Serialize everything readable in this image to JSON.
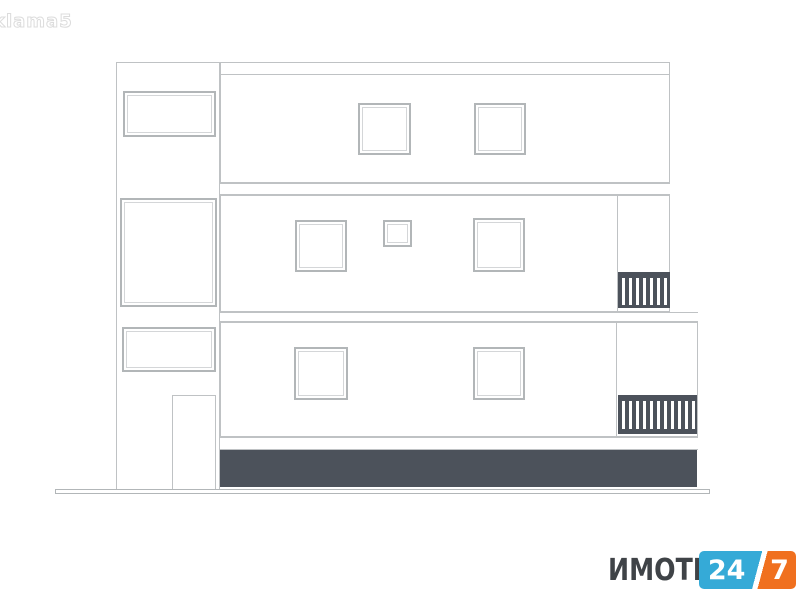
{
  "watermark": {
    "text": "klama5"
  },
  "logo": {
    "brand": "ИМОТИ",
    "badge_left": "24",
    "badge_right": "7"
  },
  "drawing": {
    "kind": "building-side-elevation",
    "floors": 3
  },
  "theme": {
    "line_color": "#bfc2c4",
    "frame_color": "#b2b6b8",
    "inner_frame_color": "#d4d6d8",
    "dark_color": "#4c525b",
    "brand_color": "#3f4347",
    "badge_blue": "#35aad7",
    "badge_orange": "#f0701f",
    "watermark_color": "#dcdcdc"
  }
}
